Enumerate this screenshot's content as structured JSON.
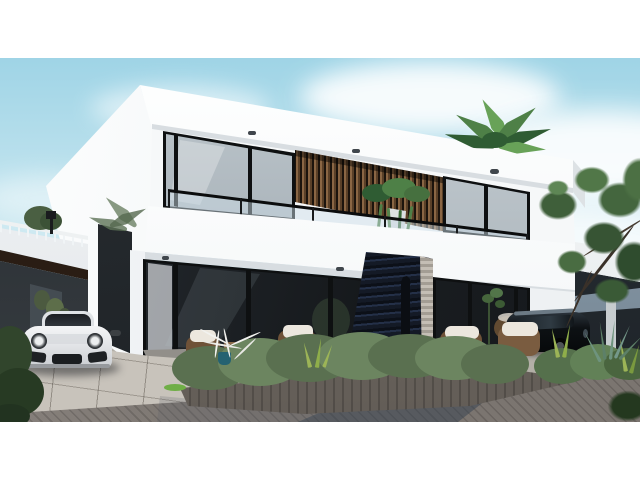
{
  "meta": {
    "type": "architectural-render",
    "description": "Photorealistic 3D exterior rendering of a modern two-storey white villa with dark glazing, wooden slat accents, a glass balcony, a dark stacked-stone feature wall, a white sports car under a carport, a black SUV at the neighbouring unit, wicker patio furniture, hedges and palm trees under a light blue sky.",
    "width": 640,
    "height": 480
  },
  "colors": {
    "sky_top": "#9fd4e6",
    "sky_mid": "#c9e7f0",
    "sky_low": "#edf5f7",
    "cloud": "#ffffff",
    "wall": "#f6f8f9",
    "wall_bright": "#fdfefe",
    "wall_shade": "#dfe4e7",
    "soffit_shade": "#d8dde1",
    "frame_dark": "#0e1011",
    "glass_hi": "#c7d0d6",
    "glass_lo": "#8d979e",
    "ground_glass_hi": "#2a3036",
    "ground_glass_lo": "#15181b",
    "slat_light": "#8a6644",
    "slat_dark": "#1c140d",
    "stone": "#141a26",
    "stone_hi": "#243048",
    "stone_trim": "#b7b1a8",
    "wicker": "#6f5238",
    "cushion": "#ece7de",
    "wood_table": "#8a6a4a",
    "hedge_a": "#5a7050",
    "hedge_b": "#6c8560",
    "hedge_hi": "#9db28b",
    "fleck": "#d9e2d2",
    "planter": "#6d6761",
    "terrace": "#908d88",
    "curb": "#f1f1ee",
    "driveway": "#c8c3bb",
    "brick": "#7b7570",
    "shadow_blue": "#34404d",
    "car_hi": "#f4f5f6",
    "car_lo": "#c9ccd0",
    "car_glass": "#23272c",
    "suv": "#0d1114",
    "suv_glint": "#6c7a85",
    "tree_a": "#3f5f3a",
    "tree_b": "#517748",
    "tree_c": "#44663e",
    "tree_d": "#375434",
    "tree_e": "#2f4c2e",
    "palm_a": "#2f5c33",
    "palm_b": "#4e8047",
    "palm_c": "#68a258",
    "grass": "#9cb457",
    "agave": "#6e937e",
    "teal_pot": "#256271",
    "neighbor_roof": "#9aabb9",
    "brown_soffit": "#2a1d14",
    "interior_a": "#23272b",
    "interior_b": "#3a4045",
    "white": "#ffffff"
  },
  "scene": {
    "objects": [
      "modern-two-storey-villa",
      "flat-roof-parapet",
      "upper-window-band",
      "wood-slat-accent",
      "glass-balcony-railing",
      "hanging-plant",
      "floor-slab-band",
      "ground-floor-glazing",
      "stone-feature-wall",
      "carport",
      "white-sports-car",
      "black-suv",
      "neighbor-house-left",
      "neighbor-house-right",
      "roof-palm",
      "side-trees",
      "hedge-planters",
      "wicker-armchairs",
      "coffee-table",
      "white-branch-sculpture",
      "paver-driveway",
      "brick-road",
      "white-border-frame"
    ]
  }
}
